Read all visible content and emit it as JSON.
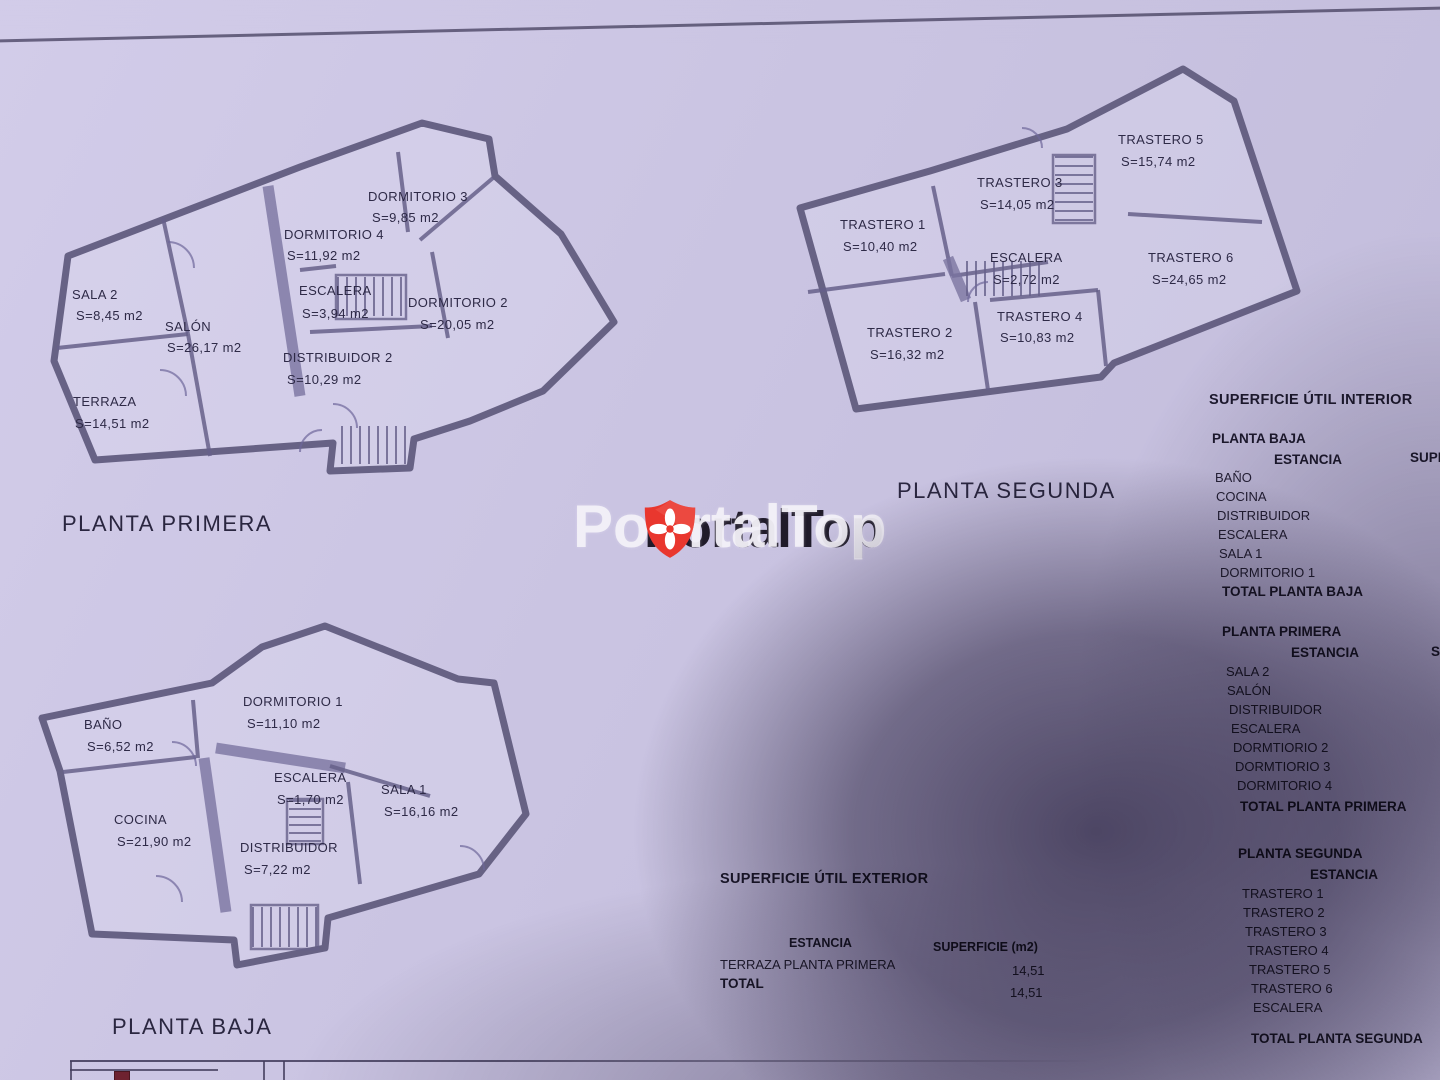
{
  "colors": {
    "paper": "#cac4e2",
    "ink": "#2b2742",
    "wall": "#5f5a7d",
    "brand_red": "#e9372e",
    "watermark_white": "#f3f1f8",
    "shadow": "#38304c"
  },
  "watermark": {
    "brand": "PortalTop",
    "shadow_text": "PortalTop",
    "logo_icon": "shield-flower-icon"
  },
  "plans": [
    {
      "title": "PLANTA PRIMERA",
      "rooms": [
        {
          "name": "SALA 2",
          "area": "S=8,45 m2"
        },
        {
          "name": "SALÓN",
          "area": "S=26,17 m2"
        },
        {
          "name": "TERRAZA",
          "area": "S=14,51 m2"
        },
        {
          "name": "DORMITORIO 4",
          "area": "S=11,92 m2"
        },
        {
          "name": "DORMITORIO 3",
          "area": "S=9,85 m2"
        },
        {
          "name": "ESCALERA",
          "area": "S=3,94 m2"
        },
        {
          "name": "DORMITORIO 2",
          "area": "S=20,05 m2"
        },
        {
          "name": "DISTRIBUIDOR 2",
          "area": "S=10,29 m2"
        }
      ]
    },
    {
      "title": "PLANTA SEGUNDA",
      "rooms": [
        {
          "name": "TRASTERO 1",
          "area": "S=10,40 m2"
        },
        {
          "name": "TRASTERO 3",
          "area": "S=14,05 m2"
        },
        {
          "name": "TRASTERO 5",
          "area": "S=15,74 m2"
        },
        {
          "name": "ESCALERA",
          "area": "S=2,72 m2"
        },
        {
          "name": "TRASTERO 6",
          "area": "S=24,65 m2"
        },
        {
          "name": "TRASTERO 2",
          "area": "S=16,32 m2"
        },
        {
          "name": "TRASTERO 4",
          "area": "S=10,83 m2"
        }
      ]
    },
    {
      "title": "PLANTA BAJA",
      "rooms": [
        {
          "name": "BAÑO",
          "area": "S=6,52 m2"
        },
        {
          "name": "DORMITORIO 1",
          "area": "S=11,10 m2"
        },
        {
          "name": "COCINA",
          "area": "S=21,90 m2"
        },
        {
          "name": "ESCALERA",
          "area": "S=1,70 m2"
        },
        {
          "name": "SALA 1",
          "area": "S=16,16 m2"
        },
        {
          "name": "DISTRIBUIDOR",
          "area": "S=7,22 m2"
        }
      ]
    }
  ],
  "interior_table": {
    "title": "SUPERFICIE ÚTIL INTERIOR",
    "col_estancia": "ESTANCIA",
    "col_superficie": "SUPERFICIE (m2)",
    "sections": [
      {
        "name": "PLANTA BAJA",
        "rows": [
          "BAÑO",
          "COCINA",
          "DISTRIBUIDOR",
          "ESCALERA",
          "SALA 1",
          "DORMITORIO 1"
        ],
        "total": "TOTAL PLANTA BAJA"
      },
      {
        "name": "PLANTA PRIMERA",
        "rows": [
          "SALA 2",
          "SALÓN",
          "DISTRIBUIDOR",
          "ESCALERA",
          "DORMTIORIO 2",
          "DORMTIORIO 3",
          "DORMITORIO 4"
        ],
        "total": "TOTAL PLANTA PRIMERA"
      },
      {
        "name": "PLANTA SEGUNDA",
        "rows": [
          "TRASTERO 1",
          "TRASTERO 2",
          "TRASTERO 3",
          "TRASTERO 4",
          "TRASTERO 5",
          "TRASTERO 6",
          "ESCALERA"
        ],
        "total": "TOTAL PLANTA SEGUNDA"
      }
    ]
  },
  "exterior_table": {
    "title": "SUPERFICIE ÚTIL EXTERIOR",
    "col_estancia": "ESTANCIA",
    "col_superficie": "SUPERFICIE (m2)",
    "rows": [
      {
        "name": "TERRAZA PLANTA PRIMERA",
        "value": "14,51"
      }
    ],
    "total_label": "TOTAL",
    "total_value": "14,51"
  }
}
